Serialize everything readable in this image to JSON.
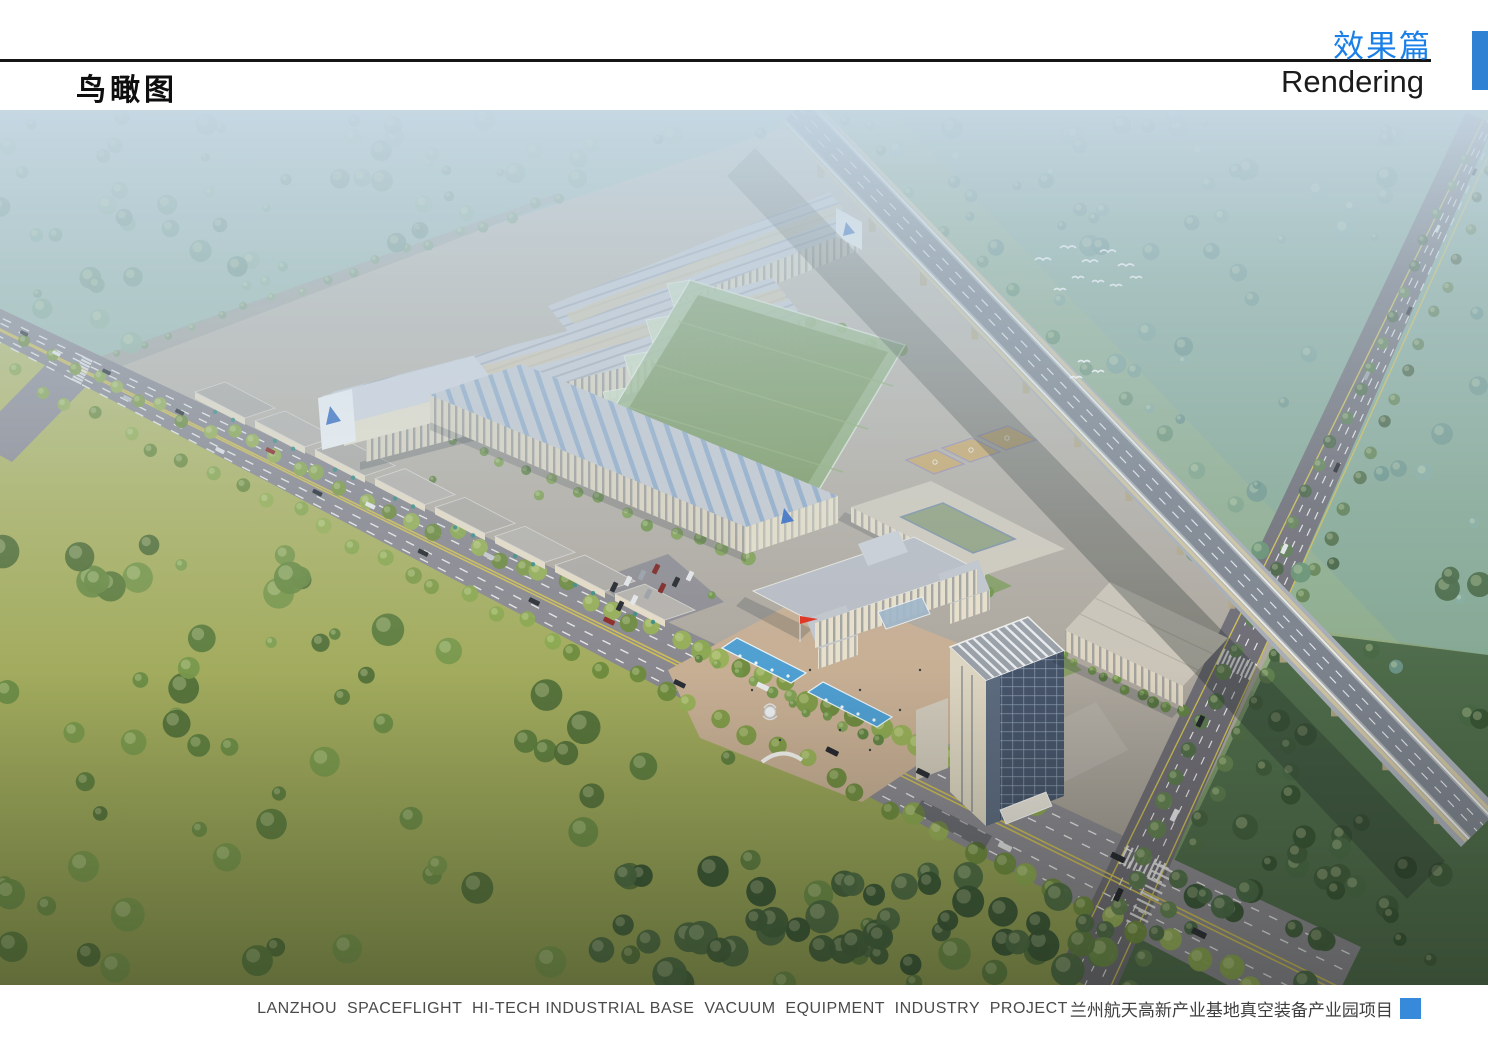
{
  "header": {
    "section_label_cn": "效果篇",
    "section_label_en": "Rendering",
    "view_title_cn": "鸟瞰图"
  },
  "caption": {
    "en": "LANZHOU  SPACEFLIGHT  HI-TECH INDUSTRIAL BASE  VACUUM  EQUIPMENT  INDUSTRY  PROJECT",
    "cn": "兰州航天高新产业基地真空装备产业园项目"
  },
  "colors": {
    "accent_blue": "#1a80e8",
    "header_tab_blue": "#2f81d3",
    "caption_marker_blue": "#3789d9",
    "pool_blue": "#4f9fd2",
    "flag_red": "#e0301e"
  },
  "scene": {
    "kind": "aerial-architectural-rendering",
    "alt": "bird's-eye view rendering of an industrial park with factories, offices, elevated highway and green fields"
  }
}
